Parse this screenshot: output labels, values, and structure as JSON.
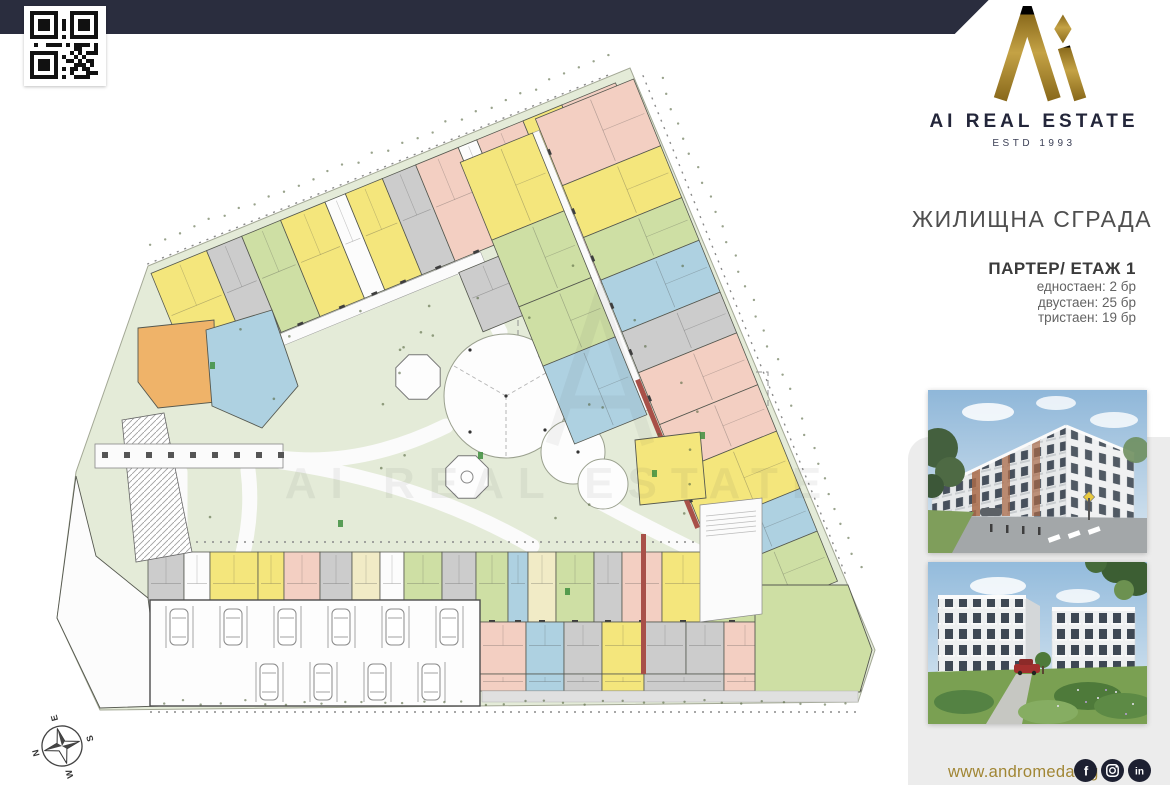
{
  "brand": {
    "name": "AI REAL ESTATE",
    "estd": "ESTD 1993",
    "gold": "#a98a2f",
    "navy": "#23263a"
  },
  "info": {
    "building_title": "ЖИЛИЩНА СГРАДА",
    "floor_title": "ПАРТЕР/ ЕТАЖ 1",
    "stats": [
      "едностаен: 2 бр",
      "двустаен: 25 бр",
      "тристаен: 19 бр"
    ]
  },
  "footer": {
    "website": "www.andromeda.bg",
    "social": [
      "facebook",
      "instagram",
      "linkedin"
    ]
  },
  "compass": {
    "n": "N",
    "e": "E",
    "s": "S",
    "w": "W"
  },
  "floor_plan": {
    "watermark": "AI REAL ESTATE",
    "palette": {
      "yellow": "#f4e67c",
      "cream": "#f1ebc6",
      "orange": "#efb369",
      "pink": "#f3cfc2",
      "blue": "#aed1e1",
      "green": "#cedfa4",
      "gray": "#cccccc",
      "white": "#fcfcfc",
      "site": "#e4ebd8",
      "red": "#a85048",
      "outline": "#55584f"
    },
    "site_outline": "630,68 875,650 858,702 100,710 57,618 76,472 148,266",
    "bands": [
      {
        "x": 148,
        "y": 266,
        "a": -22.3,
        "x0": 0,
        "y0": 8,
        "d": 104,
        "doors": true,
        "corridor": [
          58,
          113,
          255,
          12
        ],
        "units": [
          [
            "yellow",
            60
          ],
          [
            "gray",
            38
          ],
          [
            "green",
            42
          ],
          [
            "yellow",
            48
          ],
          [
            "white",
            22
          ],
          [
            "yellow",
            40
          ],
          [
            "gray",
            36
          ],
          [
            "pink",
            46
          ],
          [
            "white",
            20
          ],
          [
            "pink",
            50
          ],
          [
            "yellow",
            42
          ],
          [
            "pink",
            58
          ]
        ],
        "extras": [
          [
            8,
            112,
            46,
            34,
            "yellow"
          ]
        ]
      },
      {
        "x": 148,
        "y": 266,
        "a": -22.3,
        "x0": 285,
        "y0": 124,
        "d": 64,
        "units": [
          [
            "gray",
            50
          ],
          [
            "yellow",
            72
          ],
          [
            "pink",
            60
          ],
          [
            "yellow",
            42
          ]
        ]
      },
      {
        "x": 641,
        "y": 76,
        "a": 67.9,
        "x0": 0,
        "y0": 8,
        "d": 106,
        "doors": true,
        "corridor": [
          12,
          115,
          300,
          12
        ],
        "stripe": [
          280,
          115,
          160,
          5
        ],
        "units": [
          [
            "pink",
            72
          ],
          [
            "yellow",
            56
          ],
          [
            "green",
            46
          ],
          [
            "blue",
            56
          ],
          [
            "gray",
            44
          ],
          [
            "pink",
            56
          ],
          [
            "pink",
            50
          ],
          [
            "yellow",
            62
          ],
          [
            "blue",
            46
          ],
          [
            "green",
            54
          ]
        ]
      },
      {
        "x": 641,
        "y": 76,
        "a": 67.9,
        "x0": 12,
        "y0": 122,
        "d": 78,
        "units": [
          [
            "yellow",
            84
          ],
          [
            "green",
            72
          ],
          [
            "green",
            64
          ],
          [
            "blue",
            84
          ]
        ]
      },
      {
        "x": 148,
        "y": 552,
        "a": 0,
        "x0": 0,
        "y0": 0,
        "d": 70,
        "doors": true,
        "units": [
          [
            "gray",
            36
          ],
          [
            "white",
            26
          ],
          [
            "yellow",
            48
          ],
          [
            "yellow",
            26
          ],
          [
            "pink",
            36
          ],
          [
            "gray",
            32
          ],
          [
            "cream",
            28
          ],
          [
            "white",
            24
          ],
          [
            "green",
            38
          ],
          [
            "gray",
            34
          ],
          [
            "green",
            32
          ],
          [
            "blue",
            20
          ],
          [
            "cream",
            28
          ],
          [
            "green",
            38
          ],
          [
            "gray",
            28
          ],
          [
            "pink",
            40
          ],
          [
            "yellow",
            42
          ],
          [
            "green",
            56
          ]
        ]
      },
      {
        "x": 480,
        "y": 622,
        "a": 0,
        "x0": 0,
        "y0": 0,
        "d": 52,
        "units": [
          [
            "pink",
            46
          ],
          [
            "blue",
            38
          ],
          [
            "gray",
            38
          ],
          [
            "yellow",
            42
          ],
          [
            "gray",
            42
          ],
          [
            "gray",
            38
          ],
          [
            "pink",
            42
          ],
          [
            "yellow",
            40
          ],
          [
            "green",
            55
          ]
        ]
      },
      {
        "x": 480,
        "y": 674,
        "a": 0,
        "x0": 0,
        "y0": 0,
        "d": 17,
        "units": [
          [
            "pink",
            46
          ],
          [
            "blue",
            38
          ],
          [
            "gray",
            38
          ],
          [
            "yellow",
            42
          ],
          [
            "gray",
            80
          ],
          [
            "pink",
            42
          ],
          [
            "yellow",
            40
          ],
          [
            "green",
            55
          ]
        ]
      }
    ],
    "polygons": [
      {
        "c": "orange",
        "pts": "138,328 214,320 216,402 158,408 138,382"
      },
      {
        "c": "blue",
        "pts": "206,330 272,310 298,386 262,428 212,406"
      },
      {
        "c": "yellow",
        "pts": "635,440 700,432 706,498 640,505"
      },
      {
        "c": "green",
        "pts": "755,585 848,585 872,650 860,692 755,692"
      },
      {
        "c": "white",
        "pts": "57,618 100,708 162,706 148,598 96,556 76,476"
      }
    ],
    "garage": {
      "x": 150,
      "y": 600,
      "w": 330,
      "h": 106
    },
    "circles": [
      [
        506,
        396,
        62
      ],
      [
        573,
        452,
        32
      ],
      [
        603,
        484,
        25
      ]
    ],
    "octagons": [
      [
        418,
        377,
        24
      ],
      [
        467,
        477,
        23
      ]
    ]
  }
}
